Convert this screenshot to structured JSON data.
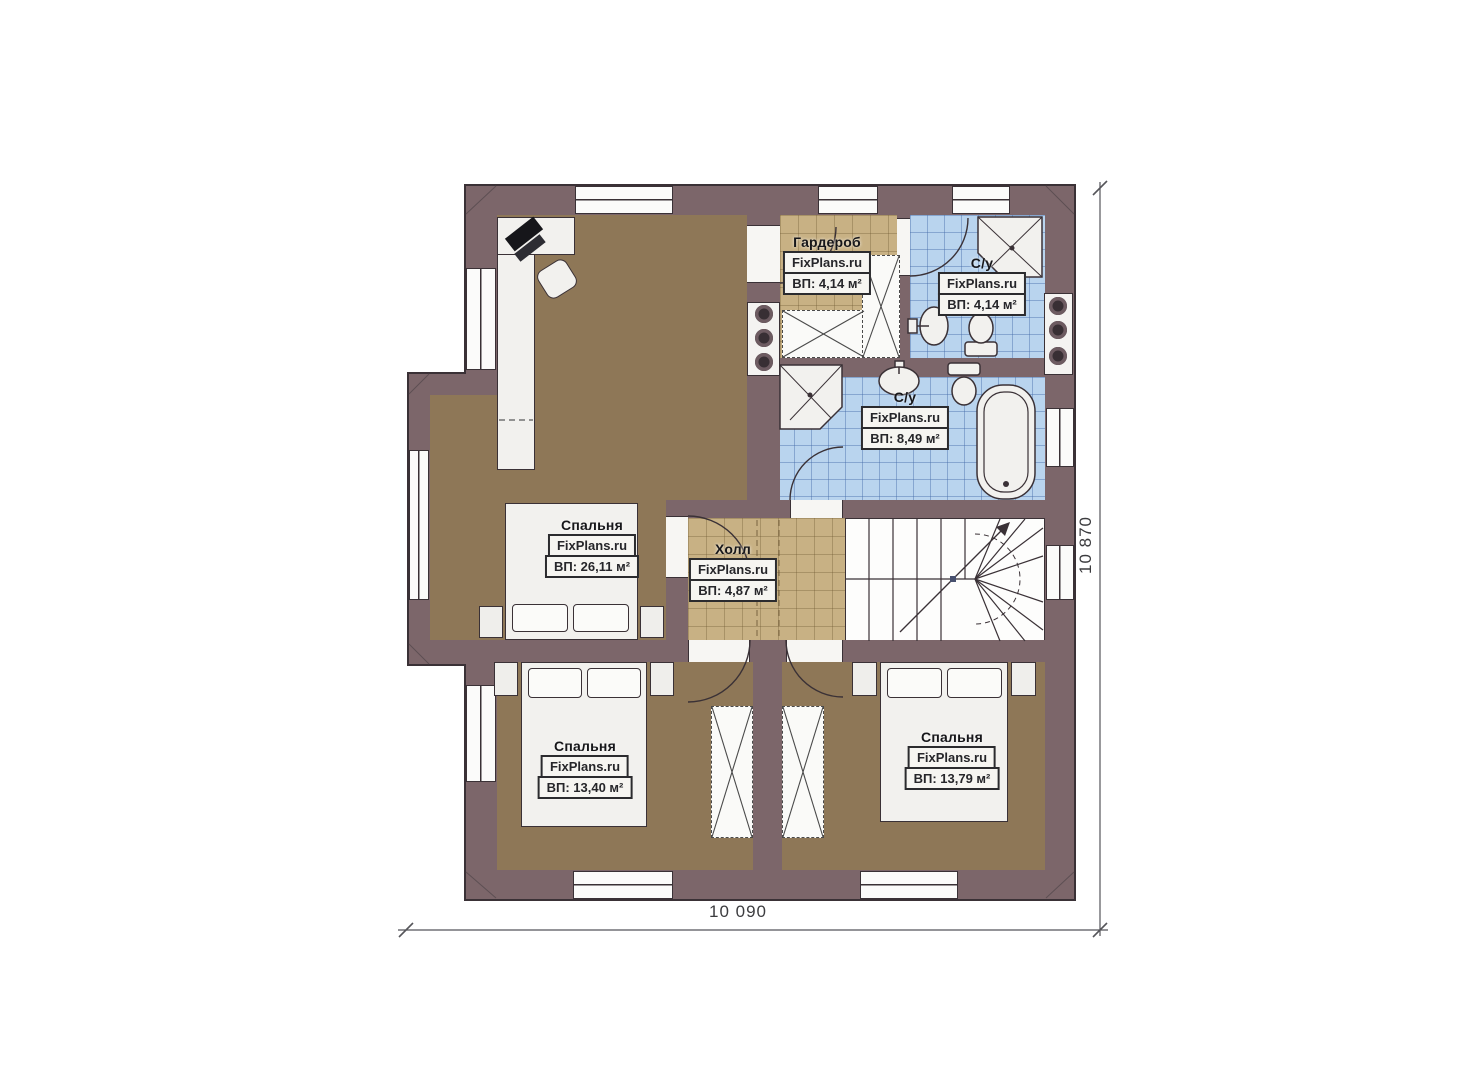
{
  "plan": {
    "rooms": [
      {
        "name": "Спальня",
        "area": "ВП: 26,11 м²"
      },
      {
        "name": "Гардероб",
        "area": "ВП: 4,14 м²"
      },
      {
        "name": "С/у",
        "area": "ВП: 4,14 м²"
      },
      {
        "name": "С/у",
        "area": "ВП: 8,49 м²"
      },
      {
        "name": "Холл",
        "area": "ВП: 4,87 м²"
      },
      {
        "name": "Спальня",
        "area": "ВП: 13,40 м²"
      },
      {
        "name": "Спальня",
        "area": "ВП: 13,79 м²"
      }
    ],
    "dimensions": {
      "width": "10 090",
      "height": "10 870"
    }
  },
  "watermark": "FixPlans.ru",
  "colors": {
    "wall": "#7c666a",
    "wood": "#8e7757",
    "tile_tan": "#c8b184",
    "tile_blue": "#b9d4ee",
    "line": "#3a3136"
  }
}
